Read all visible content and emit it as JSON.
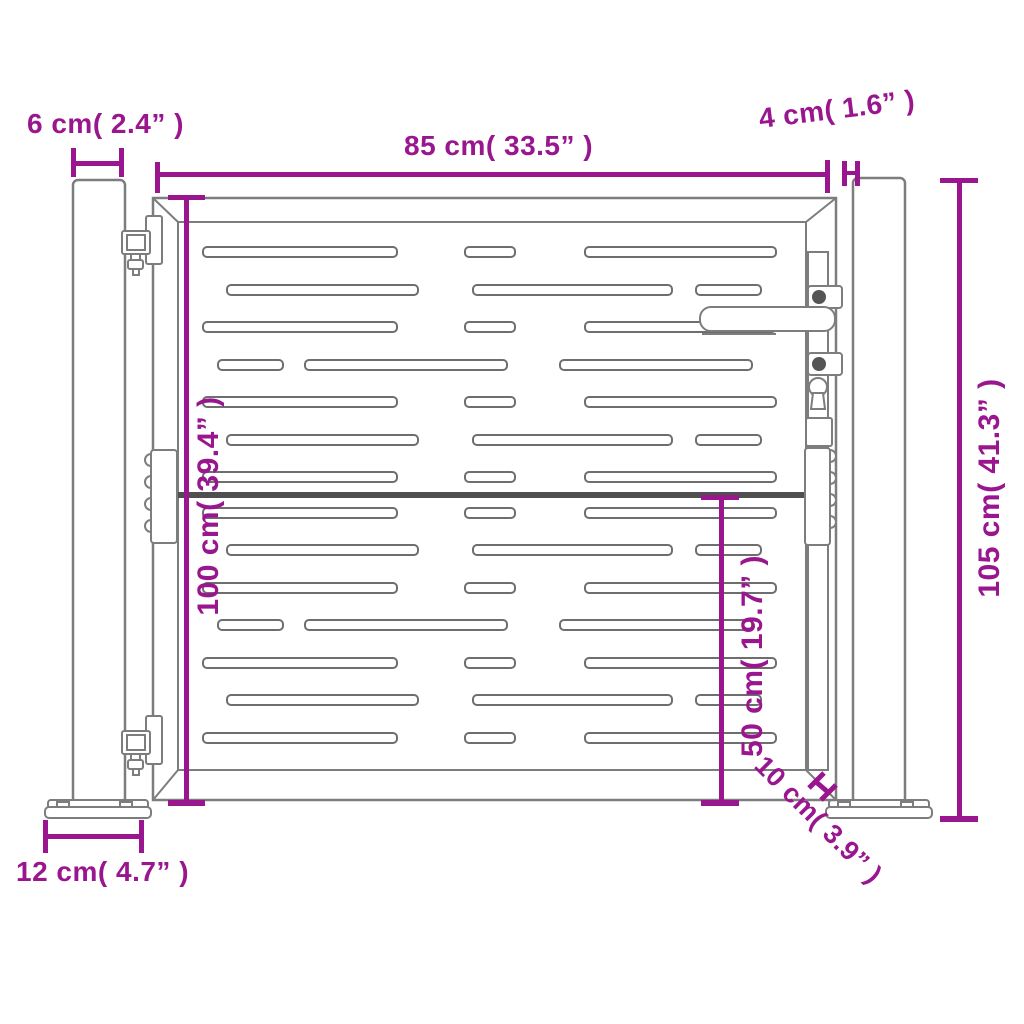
{
  "diagram": {
    "title": "Garden gate dimension diagram",
    "accent_color": "#99168E",
    "outline_color": "#7d7d7d",
    "labels": {
      "post_width": "6 cm( 2.4” )",
      "gate_width": "85 cm( 33.5” )",
      "post_gap": "4 cm( 1.6” )",
      "total_height": "105 cm( 41.3” )",
      "gate_height": "100 cm( 39.4” )",
      "half_height": "50 cm( 19.7” )",
      "base_plate_width": "12 cm( 4.7” )",
      "ground_clearance": "10 cm( 3.9” )"
    },
    "measurements": [
      {
        "id": "post_width",
        "cm": 6,
        "inch": 2.4,
        "orientation": "horizontal"
      },
      {
        "id": "gate_width",
        "cm": 85,
        "inch": 33.5,
        "orientation": "horizontal"
      },
      {
        "id": "post_gap",
        "cm": 4,
        "inch": 1.6,
        "orientation": "horizontal"
      },
      {
        "id": "total_height",
        "cm": 105,
        "inch": 41.3,
        "orientation": "vertical"
      },
      {
        "id": "gate_height",
        "cm": 100,
        "inch": 39.4,
        "orientation": "vertical"
      },
      {
        "id": "half_height",
        "cm": 50,
        "inch": 19.7,
        "orientation": "vertical"
      },
      {
        "id": "base_plate_width",
        "cm": 12,
        "inch": 4.7,
        "orientation": "horizontal"
      },
      {
        "id": "ground_clearance",
        "cm": 10,
        "inch": 3.9,
        "orientation": "diagonal"
      }
    ]
  }
}
